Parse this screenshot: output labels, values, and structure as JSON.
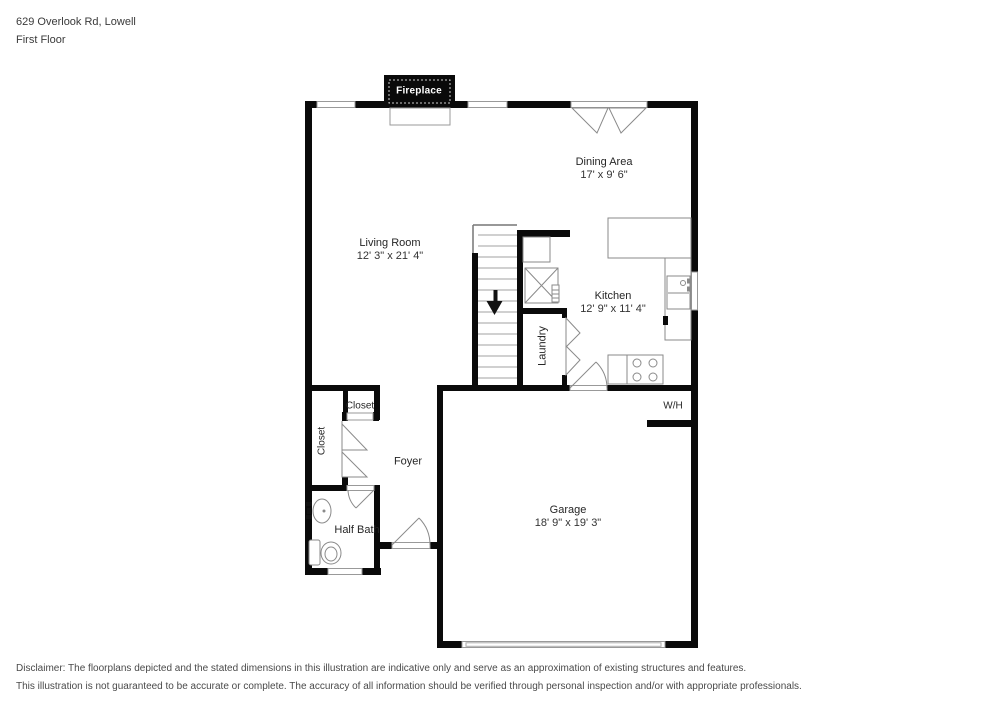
{
  "header": {
    "address": "629 Overlook Rd, Lowell",
    "floor_label": "First Floor"
  },
  "rooms": {
    "living_room": {
      "name": "Living Room",
      "dims": "12' 3\" x 21' 4\""
    },
    "dining_area": {
      "name": "Dining Area",
      "dims": "17' x 9' 6\""
    },
    "kitchen": {
      "name": "Kitchen",
      "dims": "12' 9\" x 11' 4\""
    },
    "garage": {
      "name": "Garage",
      "dims": "18' 9\" x 19' 3\""
    },
    "laundry": {
      "name": "Laundry"
    },
    "foyer": {
      "name": "Foyer"
    },
    "half_bath": {
      "name": "Half Bath"
    },
    "closet_hall": {
      "name": "Closet"
    },
    "closet_entry": {
      "name": "Closet"
    },
    "fireplace": {
      "name": "Fireplace"
    },
    "water_heater": {
      "name": "W/H"
    }
  },
  "colors": {
    "wall": "#0a0a0a",
    "fixture_line": "#8a8a8a",
    "text": "#262626"
  },
  "disclaimer": {
    "line1": "Disclaimer: The floorplans depicted and the stated dimensions in this illustration are indicative only and serve as an approximation of existing structures and features.",
    "line2": "This illustration is not guaranteed to be accurate or complete. The accuracy of all information should be verified through personal inspection and/or with appropriate professionals."
  }
}
